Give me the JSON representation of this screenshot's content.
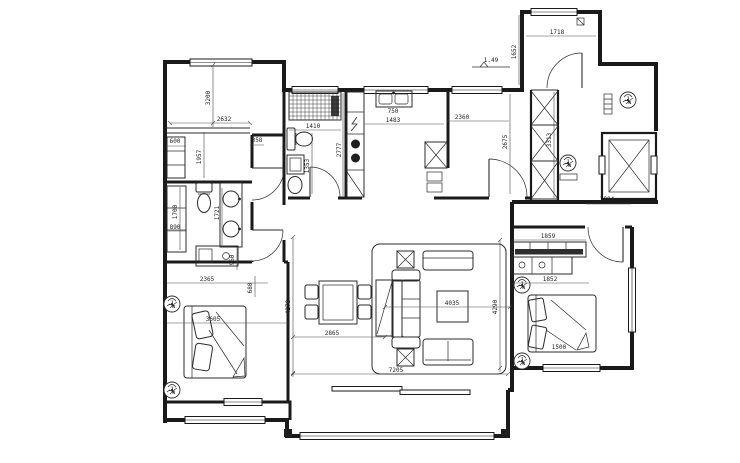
{
  "colors": {
    "line": "#1a1a1a",
    "dim": "#4a4a4a",
    "background": "#ffffff"
  },
  "dims": {
    "tl_bedroom_height": "3200",
    "tl_bedroom_width": "2632",
    "tl_nook_width": "600",
    "tl_lower_height": "1957",
    "corridor_gap": "358",
    "bath_left_closet_height": "1700",
    "bath_left_width": "890",
    "bath_left_vanity_height": "1721",
    "bl_dresser_width": "2365",
    "bl_gap_width": "680",
    "bl_nook_depth": "960",
    "bl_room_width": "3605",
    "bath_top_width": "1410",
    "bath_top_depth": "1353",
    "kitchen_wall_height": "2777",
    "kitchen_width": "1483",
    "kitchen_sink_width": "750",
    "entry_width": "2360",
    "entry_depth": "2675",
    "shaft_height": "3313",
    "tr_room_width": "1718",
    "tr_room_depth": "1652",
    "entry_level": "1.49",
    "r_bedroom_top_width": "3004",
    "wardrobe_width": "1859",
    "wardrobe_lower_width": "1852",
    "r_bed_width": "1500",
    "living_height_left": "4278",
    "dining_width": "2865",
    "living_width_inner": "4035",
    "living_height_right": "4290",
    "living_width_total": "7205"
  }
}
